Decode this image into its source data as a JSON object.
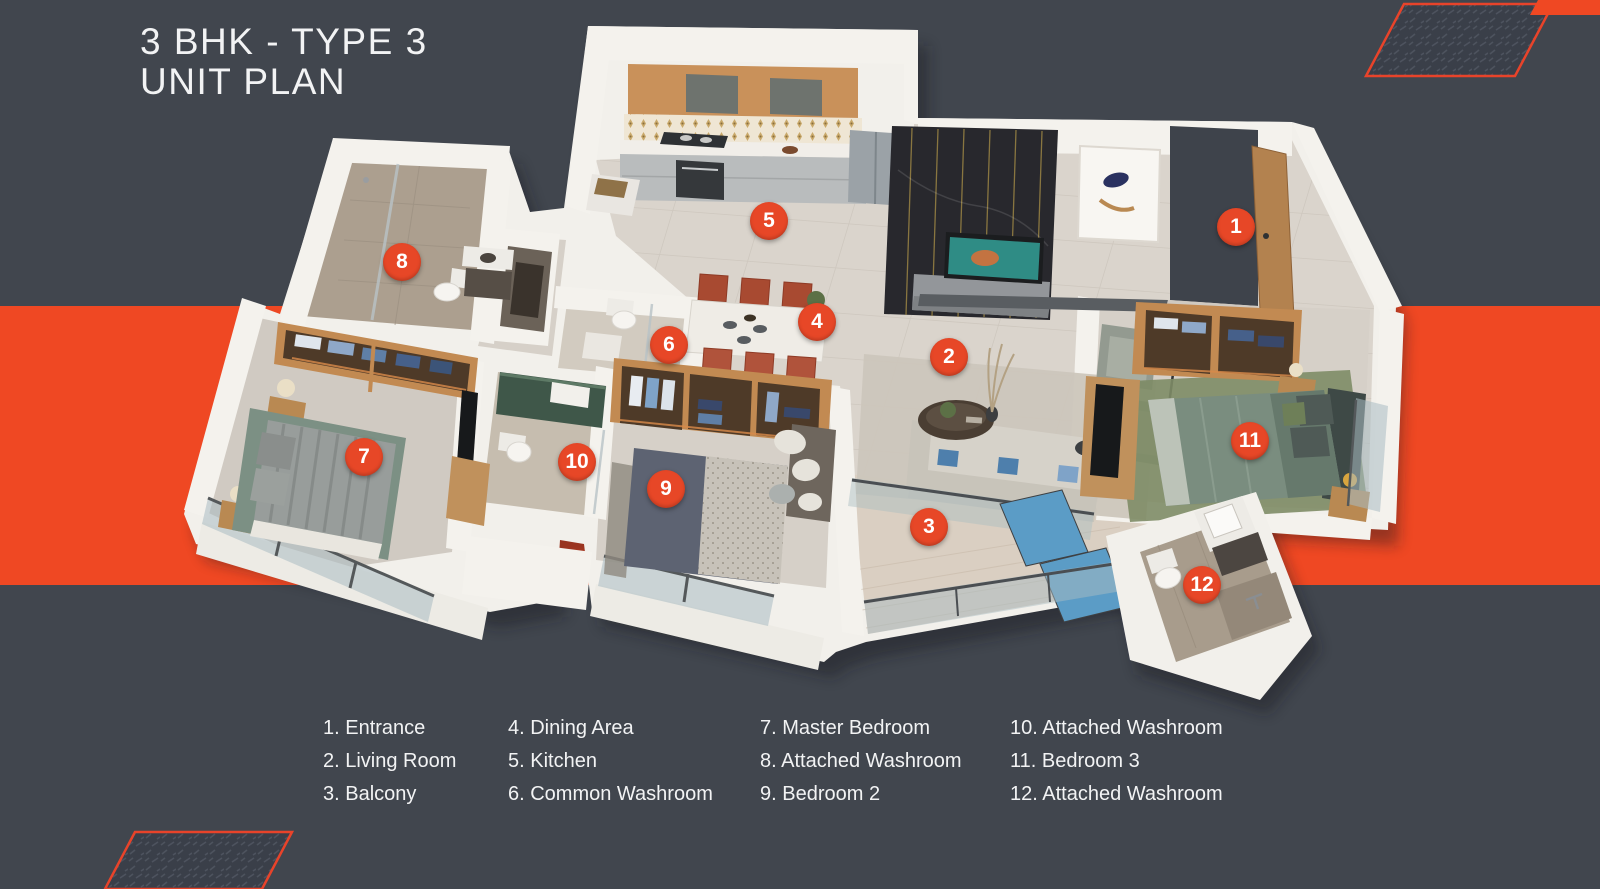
{
  "title": {
    "line1": "3 BHK - TYPE 3",
    "line2": "UNIT PLAN"
  },
  "legend": {
    "columns": [
      [
        "1. Entrance",
        "2. Living Room",
        "3. Balcony"
      ],
      [
        "4. Dining Area",
        "5. Kitchen",
        "6. Common Washroom"
      ],
      [
        "7. Master Bedroom",
        "8. Attached Washroom",
        "9. Bedroom 2"
      ],
      [
        "10. Attached Washroom",
        "11. Bedroom 3",
        "12. Attached Washroom"
      ]
    ]
  },
  "markers": [
    {
      "num": "1",
      "room": "Entrance",
      "x": 1236,
      "y": 227
    },
    {
      "num": "2",
      "room": "Living Room",
      "x": 949,
      "y": 357
    },
    {
      "num": "3",
      "room": "Balcony",
      "x": 929,
      "y": 527
    },
    {
      "num": "4",
      "room": "Dining Area",
      "x": 817,
      "y": 322
    },
    {
      "num": "5",
      "room": "Kitchen",
      "x": 769,
      "y": 221
    },
    {
      "num": "6",
      "room": "Common Washroom",
      "x": 669,
      "y": 345
    },
    {
      "num": "7",
      "room": "Master Bedroom",
      "x": 364,
      "y": 457
    },
    {
      "num": "8",
      "room": "Attached Washroom",
      "x": 402,
      "y": 262
    },
    {
      "num": "9",
      "room": "Bedroom 2",
      "x": 666,
      "y": 489
    },
    {
      "num": "10",
      "room": "Attached Washroom",
      "x": 577,
      "y": 462
    },
    {
      "num": "11",
      "room": "Bedroom 3",
      "x": 1250,
      "y": 441
    },
    {
      "num": "12",
      "room": "Attached Washroom",
      "x": 1202,
      "y": 585
    }
  ],
  "colors": {
    "bg": "#41464E",
    "band": "#EF4823",
    "accent": "#E8432A",
    "marker": "#E74727",
    "text": "#F2F3F4"
  }
}
